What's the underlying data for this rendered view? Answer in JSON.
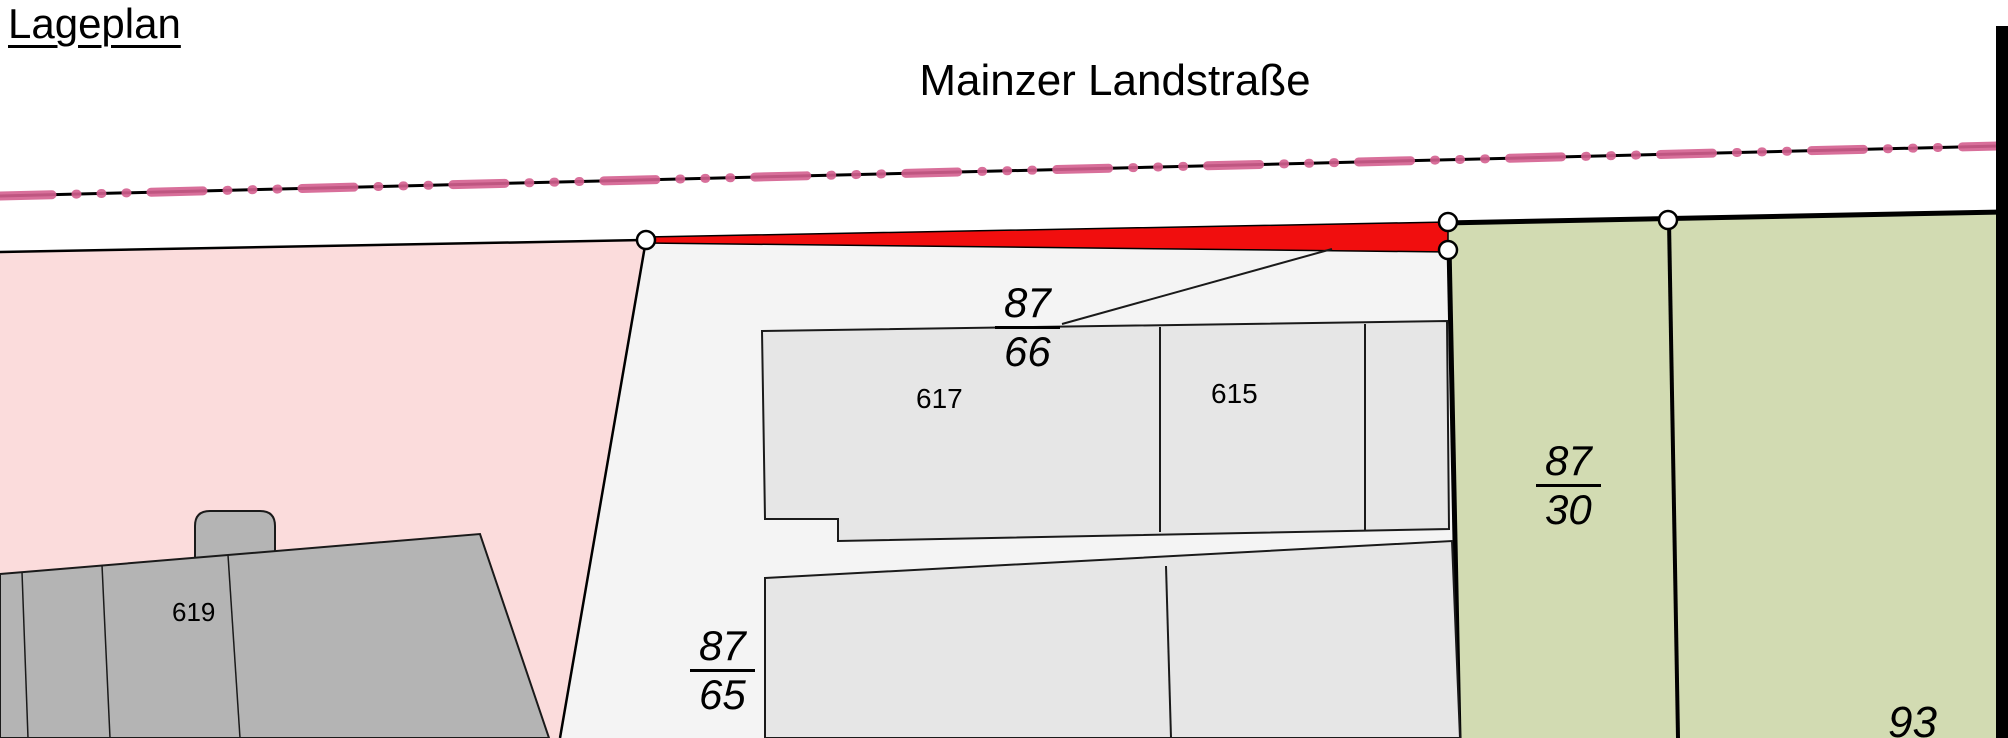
{
  "title": "Lageplan",
  "street": {
    "name": "Mainzer Landstraße"
  },
  "labels": {
    "parcel_87_66": {
      "num": "87",
      "den": "66"
    },
    "parcel_87_65": {
      "num": "87",
      "den": "65"
    },
    "parcel_87_30": {
      "num": "87",
      "den": "30"
    },
    "parcel_93": "93",
    "building_617": "617",
    "building_615": "615",
    "building_619": "619"
  },
  "colors": {
    "parcel_pink": "#fbdcdc",
    "parcel_white": "#f4f4f4",
    "parcel_green": "#d2dbb2",
    "building_light": "#e6e6e6",
    "building_dark": "#b4b4b4",
    "highlight_red": "#f10e0e",
    "street_marking_pink": "#d45f8f",
    "survey_point_fill": "#ffffff",
    "line_black": "#000000"
  }
}
